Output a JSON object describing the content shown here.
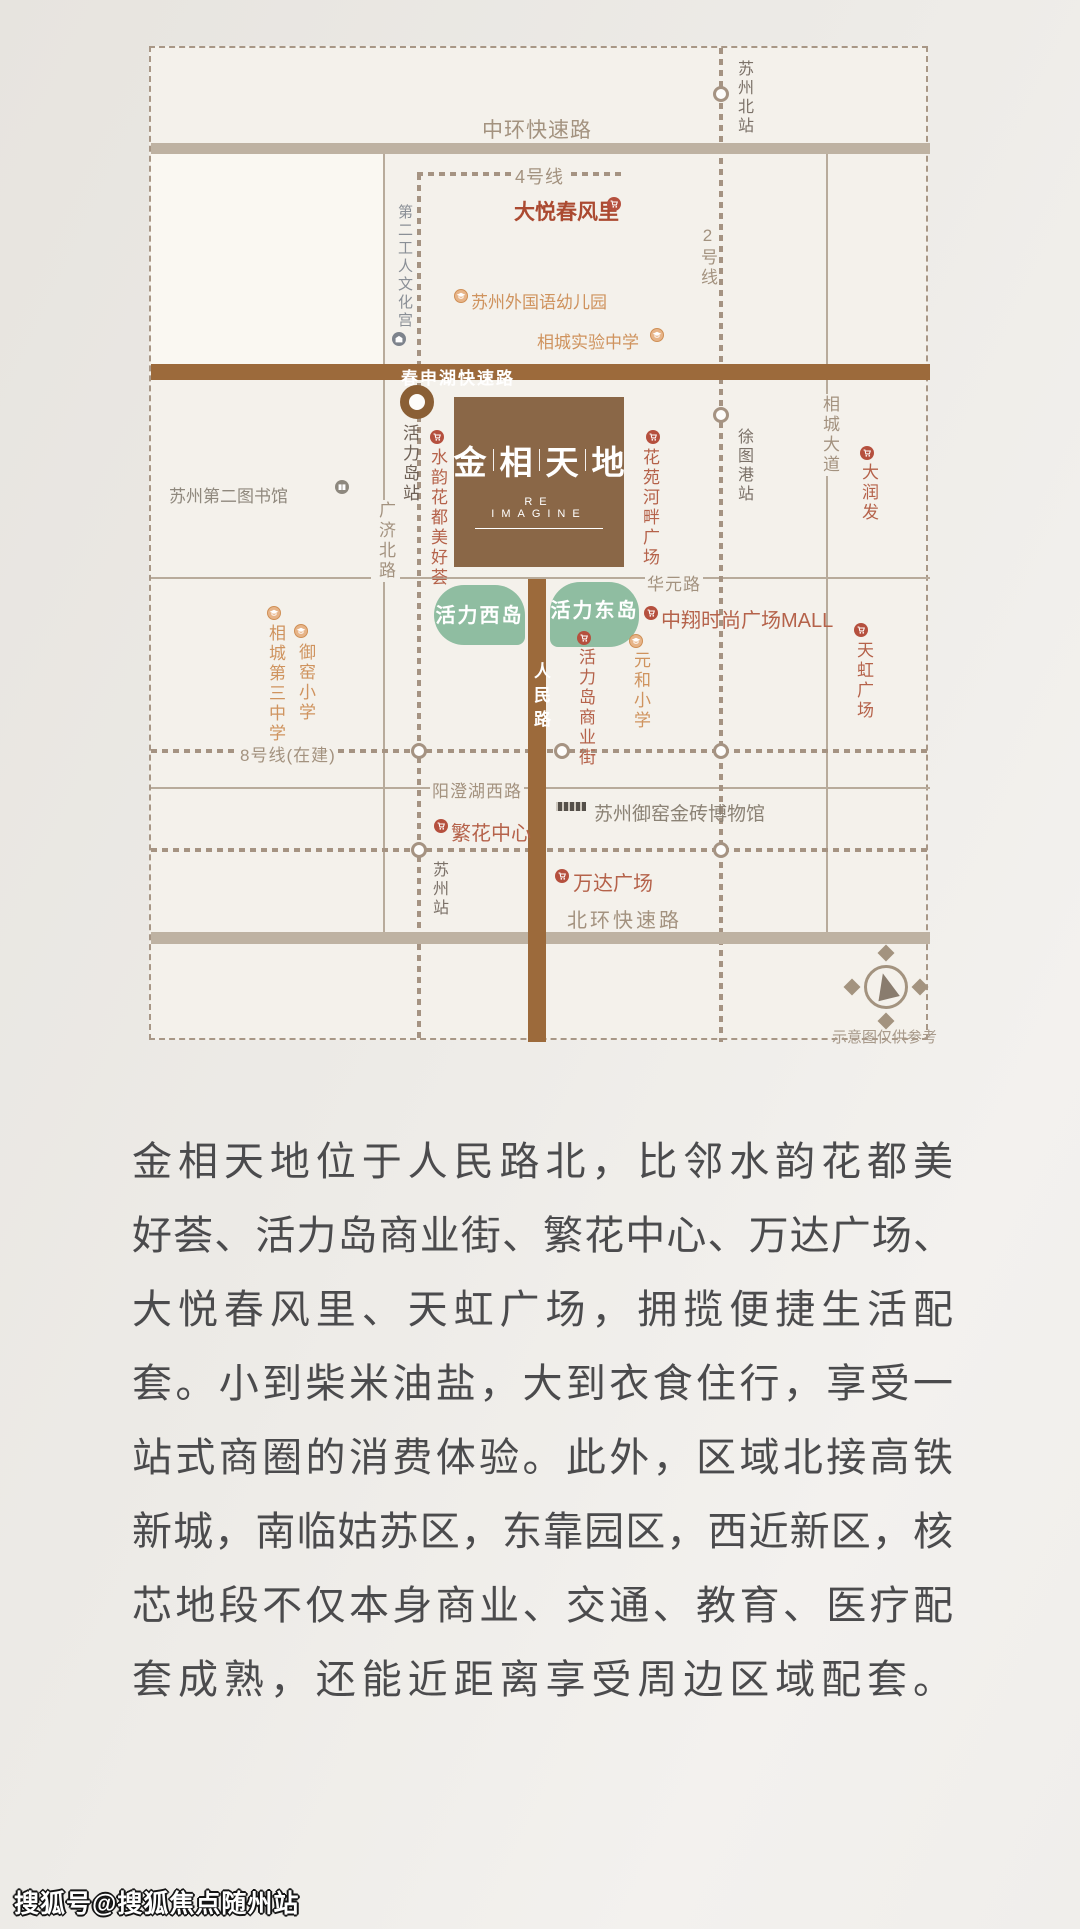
{
  "colors": {
    "brand_brown": "#8a6747",
    "road_brown": "#9c6a3b",
    "road_tan": "#beb2a2",
    "metro_dash": "#a59382",
    "island_green": "#8fbda1",
    "poi_red": "#b5624a",
    "accent_red": "#ab4a31",
    "school_orange": "#cf935e",
    "road_label": "#a3927f",
    "station_label": "#7b7168",
    "body_text": "#4b4b4d",
    "map_bg": "#f4f1eb"
  },
  "map": {
    "roads": {
      "zhonghuan": "中环快速路",
      "chunshen": "春申湖快速路",
      "huayuan": "华元路",
      "renmin": "人民路",
      "guangji": "广济北路",
      "xiangcheng_dadao": "相城大道",
      "yangcheng": "阳澄湖西路",
      "beihuan": "北环快速路"
    },
    "metro": {
      "line4": "4号线",
      "line2": "2号线",
      "line8": "8号线(在建)"
    },
    "stations": {
      "suzhou_north": "苏州北站",
      "huolidao": "活力岛站",
      "xutugang": "徐图港站",
      "suzhou": "苏州站"
    },
    "logo": {
      "chars": [
        "金",
        "相",
        "天",
        "地"
      ],
      "subtitle": "RE IMAGINE"
    },
    "islands": {
      "west": "活力西岛",
      "east": "活力东岛"
    },
    "pois": {
      "dayue": "大悦春风里",
      "kindergarten": "苏州外国语幼儿园",
      "xiangcheng_middle": "相城实验中学",
      "wenhuagong": "第二工人文化宫",
      "shuiyun": "水韵花都美好荟",
      "library": "苏州第二图书馆",
      "huayuan_plaza": "花苑河畔广场",
      "darunfa": "大润发",
      "shangyejie": "活力岛商业街",
      "yuanhe": "元和小学",
      "zhongxiang": "中翔时尚广场MALL",
      "tianhong": "天虹广场",
      "no3_middle": "相城第三中学",
      "yuyao": "御窑小学",
      "fanhua": "繁花中心",
      "museum": "苏州御窑金砖博物馆",
      "wanda": "万达广场"
    },
    "note": "示意图仅供参考"
  },
  "body": {
    "lines": [
      "金相天地位于人民路北，比邻水韵花都美",
      "好荟、活力岛商业街、繁花中心、万达广场、",
      "大悦春风里、天虹广场，拥揽便捷生活配",
      "套。小到柴米油盐，大到衣食住行，享受一",
      "站式商圈的消费体验。此外，区域北接高铁",
      "新城，南临姑苏区，东靠园区，西近新区，核",
      "芯地段不仅本身商业、交通、教育、医疗配",
      "套成熟，还能近距离享受周边区域配套。"
    ]
  },
  "watermark": "搜狐号@搜狐焦点随州站"
}
